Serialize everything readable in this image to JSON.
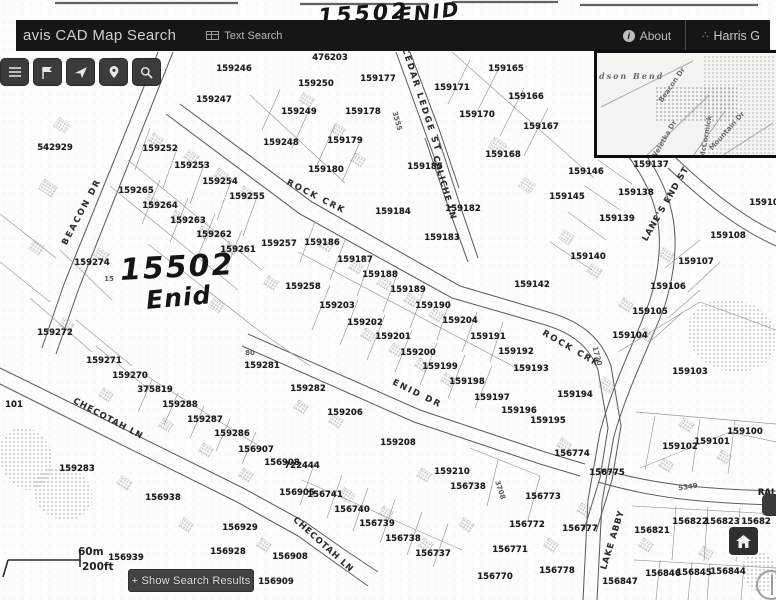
{
  "annotations": {
    "top_number": "15502",
    "top_street": "ENID",
    "map_number": "15502",
    "map_street": "Enid"
  },
  "header": {
    "title": "avis CAD Map Search",
    "text_search": "Text Search",
    "about": "About",
    "brand": "Harris G"
  },
  "toolbar": {
    "buttons": [
      "menu",
      "flag",
      "send-arrow",
      "location-pin",
      "search"
    ]
  },
  "map": {
    "scale": {
      "metric": "60m",
      "imperial": "200ft"
    },
    "show_results_label": "+ Show Search Results",
    "streets": [
      {
        "t": "BEACON DR",
        "x": 82,
        "y": 212,
        "r": -62,
        "ls": 2
      },
      {
        "t": "ROCK CRK",
        "x": 316,
        "y": 197,
        "r": 27,
        "ls": 2
      },
      {
        "t": "ROCK CRK",
        "x": 571,
        "y": 349,
        "r": 30,
        "ls": 2
      },
      {
        "t": "CEDAR LEDGE ST",
        "x": 421,
        "y": 100,
        "r": 72,
        "ls": 2
      },
      {
        "t": "CALICHE LN",
        "x": 444,
        "y": 188,
        "r": 74,
        "ls": 1
      },
      {
        "t": "LANE'S END ST",
        "x": 666,
        "y": 204,
        "r": -60,
        "ls": 1
      },
      {
        "t": "ENID DR",
        "x": 417,
        "y": 394,
        "r": 26,
        "ls": 2
      },
      {
        "t": "CHECOTAH LN",
        "x": 108,
        "y": 419,
        "r": 28,
        "ls": 1
      },
      {
        "t": "CHECOTAH LN",
        "x": 323,
        "y": 545,
        "r": 42,
        "ls": 1
      },
      {
        "t": "LAKE ABBY",
        "x": 613,
        "y": 540,
        "r": -73,
        "ls": 1
      }
    ],
    "parcels": [
      {
        "t": "542929",
        "x": 55,
        "y": 148
      },
      {
        "t": "159247",
        "x": 214,
        "y": 100
      },
      {
        "t": "159246",
        "x": 234,
        "y": 69
      },
      {
        "t": "476203",
        "x": 330,
        "y": 58
      },
      {
        "t": "159250",
        "x": 316,
        "y": 84
      },
      {
        "t": "159249",
        "x": 299,
        "y": 112
      },
      {
        "t": "159248",
        "x": 281,
        "y": 143
      },
      {
        "t": "159177",
        "x": 378,
        "y": 79
      },
      {
        "t": "159178",
        "x": 363,
        "y": 112
      },
      {
        "t": "159179",
        "x": 345,
        "y": 141
      },
      {
        "t": "159180",
        "x": 326,
        "y": 170
      },
      {
        "t": "159252",
        "x": 160,
        "y": 149
      },
      {
        "t": "159253",
        "x": 192,
        "y": 166
      },
      {
        "t": "159254",
        "x": 220,
        "y": 182
      },
      {
        "t": "159255",
        "x": 247,
        "y": 197
      },
      {
        "t": "159265",
        "x": 136,
        "y": 191
      },
      {
        "t": "159264",
        "x": 160,
        "y": 206
      },
      {
        "t": "159263",
        "x": 188,
        "y": 221
      },
      {
        "t": "159262",
        "x": 214,
        "y": 235
      },
      {
        "t": "159261",
        "x": 238,
        "y": 250
      },
      {
        "t": "159257",
        "x": 279,
        "y": 244
      },
      {
        "t": "159258",
        "x": 303,
        "y": 287
      },
      {
        "t": "159274",
        "x": 92,
        "y": 263
      },
      {
        "t": "159272",
        "x": 55,
        "y": 333
      },
      {
        "t": "159271",
        "x": 104,
        "y": 361
      },
      {
        "t": "159270",
        "x": 130,
        "y": 376
      },
      {
        "t": "375819",
        "x": 155,
        "y": 390
      },
      {
        "t": "101",
        "x": 14,
        "y": 405
      },
      {
        "t": "159283",
        "x": 77,
        "y": 469
      },
      {
        "t": "159288",
        "x": 180,
        "y": 405
      },
      {
        "t": "159287",
        "x": 205,
        "y": 420
      },
      {
        "t": "159286",
        "x": 232,
        "y": 434
      },
      {
        "t": "159281",
        "x": 262,
        "y": 366
      },
      {
        "t": "159282",
        "x": 308,
        "y": 389
      },
      {
        "t": "159206",
        "x": 345,
        "y": 413
      },
      {
        "t": "159208",
        "x": 398,
        "y": 443
      },
      {
        "t": "159210",
        "x": 452,
        "y": 472
      },
      {
        "t": "156738",
        "x": 468,
        "y": 487
      },
      {
        "t": "159165",
        "x": 506,
        "y": 69
      },
      {
        "t": "159166",
        "x": 526,
        "y": 97
      },
      {
        "t": "159171",
        "x": 452,
        "y": 88
      },
      {
        "t": "159170",
        "x": 477,
        "y": 115
      },
      {
        "t": "159167",
        "x": 541,
        "y": 127
      },
      {
        "t": "159168",
        "x": 503,
        "y": 155
      },
      {
        "t": "159185",
        "x": 425,
        "y": 167
      },
      {
        "t": "159184",
        "x": 393,
        "y": 212
      },
      {
        "t": "159183",
        "x": 442,
        "y": 238
      },
      {
        "t": "159182",
        "x": 463,
        "y": 209
      },
      {
        "t": "159186",
        "x": 322,
        "y": 243
      },
      {
        "t": "159187",
        "x": 355,
        "y": 260
      },
      {
        "t": "159188",
        "x": 380,
        "y": 275
      },
      {
        "t": "159189",
        "x": 408,
        "y": 290
      },
      {
        "t": "159190",
        "x": 433,
        "y": 306
      },
      {
        "t": "159203",
        "x": 337,
        "y": 306
      },
      {
        "t": "159202",
        "x": 365,
        "y": 323
      },
      {
        "t": "159201",
        "x": 393,
        "y": 337
      },
      {
        "t": "159200",
        "x": 418,
        "y": 353
      },
      {
        "t": "159199",
        "x": 440,
        "y": 367
      },
      {
        "t": "159198",
        "x": 467,
        "y": 382
      },
      {
        "t": "159204",
        "x": 460,
        "y": 321
      },
      {
        "t": "159191",
        "x": 488,
        "y": 337
      },
      {
        "t": "159192",
        "x": 516,
        "y": 352
      },
      {
        "t": "159197",
        "x": 492,
        "y": 398
      },
      {
        "t": "159193",
        "x": 531,
        "y": 369
      },
      {
        "t": "159194",
        "x": 575,
        "y": 395
      },
      {
        "t": "159196",
        "x": 519,
        "y": 411
      },
      {
        "t": "159195",
        "x": 548,
        "y": 421
      },
      {
        "t": "159137",
        "x": 651,
        "y": 165
      },
      {
        "t": "159138",
        "x": 636,
        "y": 193
      },
      {
        "t": "159139",
        "x": 617,
        "y": 219
      },
      {
        "t": "159140",
        "x": 588,
        "y": 257
      },
      {
        "t": "159146",
        "x": 586,
        "y": 172
      },
      {
        "t": "159145",
        "x": 567,
        "y": 197
      },
      {
        "t": "159142",
        "x": 532,
        "y": 285
      },
      {
        "t": "15910",
        "x": 764,
        "y": 203
      },
      {
        "t": "159108",
        "x": 728,
        "y": 236
      },
      {
        "t": "159107",
        "x": 696,
        "y": 262
      },
      {
        "t": "159106",
        "x": 668,
        "y": 287
      },
      {
        "t": "159105",
        "x": 650,
        "y": 312
      },
      {
        "t": "159104",
        "x": 630,
        "y": 336
      },
      {
        "t": "159103",
        "x": 690,
        "y": 372
      },
      {
        "t": "159100",
        "x": 745,
        "y": 432
      },
      {
        "t": "159102",
        "x": 680,
        "y": 447
      },
      {
        "t": "159101",
        "x": 712,
        "y": 442
      },
      {
        "t": "156822",
        "x": 690,
        "y": 522
      },
      {
        "t": "156823",
        "x": 722,
        "y": 522
      },
      {
        "t": "15682",
        "x": 756,
        "y": 522
      },
      {
        "t": "156821",
        "x": 652,
        "y": 531
      },
      {
        "t": "156846",
        "x": 663,
        "y": 574
      },
      {
        "t": "156845",
        "x": 694,
        "y": 573
      },
      {
        "t": "156844",
        "x": 728,
        "y": 572
      },
      {
        "t": "156847",
        "x": 620,
        "y": 582
      },
      {
        "t": "156770",
        "x": 495,
        "y": 577
      },
      {
        "t": "156771",
        "x": 510,
        "y": 550
      },
      {
        "t": "156772",
        "x": 527,
        "y": 525
      },
      {
        "t": "156773",
        "x": 543,
        "y": 497
      },
      {
        "t": "156774",
        "x": 572,
        "y": 454
      },
      {
        "t": "156775",
        "x": 607,
        "y": 473
      },
      {
        "t": "156777",
        "x": 580,
        "y": 529
      },
      {
        "t": "156778",
        "x": 557,
        "y": 571
      },
      {
        "t": "156737",
        "x": 433,
        "y": 554
      },
      {
        "t": "156738",
        "x": 403,
        "y": 539
      },
      {
        "t": "156739",
        "x": 377,
        "y": 524
      },
      {
        "t": "156740",
        "x": 352,
        "y": 510
      },
      {
        "t": "156741",
        "x": 325,
        "y": 495
      },
      {
        "t": "156905",
        "x": 297,
        "y": 493
      },
      {
        "t": "722444",
        "x": 302,
        "y": 466
      },
      {
        "t": "156908",
        "x": 282,
        "y": 463
      },
      {
        "t": "156907",
        "x": 256,
        "y": 450
      },
      {
        "t": "156938",
        "x": 163,
        "y": 498
      },
      {
        "t": "156939",
        "x": 126,
        "y": 558
      },
      {
        "t": "156929",
        "x": 240,
        "y": 528
      },
      {
        "t": "156928",
        "x": 228,
        "y": 552
      },
      {
        "t": "156908",
        "x": 290,
        "y": 557
      },
      {
        "t": "156909",
        "x": 276,
        "y": 582
      },
      {
        "t": "RAI",
        "x": 766,
        "y": 493
      }
    ],
    "small_labels": [
      {
        "t": "15",
        "x": 109,
        "y": 279
      },
      {
        "t": "80",
        "x": 250,
        "y": 353
      },
      {
        "t": "3555",
        "x": 397,
        "y": 121,
        "r": 75
      },
      {
        "t": "1720",
        "x": 597,
        "y": 356,
        "r": 75
      },
      {
        "t": "5349",
        "x": 688,
        "y": 487,
        "r": -8
      },
      {
        "t": "3708",
        "x": 500,
        "y": 490,
        "r": 72
      }
    ]
  },
  "inset": {
    "place_label": "dson Bend",
    "streets": [
      {
        "t": "Beacon Dr",
        "x": 669,
        "y": 82,
        "r": -55
      },
      {
        "t": "Weletka Dr",
        "x": 661,
        "y": 137,
        "r": -60
      },
      {
        "t": "McCormick",
        "x": 703,
        "y": 134,
        "r": -80
      },
      {
        "t": "Mountain Dr",
        "x": 724,
        "y": 128,
        "r": -48
      }
    ]
  }
}
